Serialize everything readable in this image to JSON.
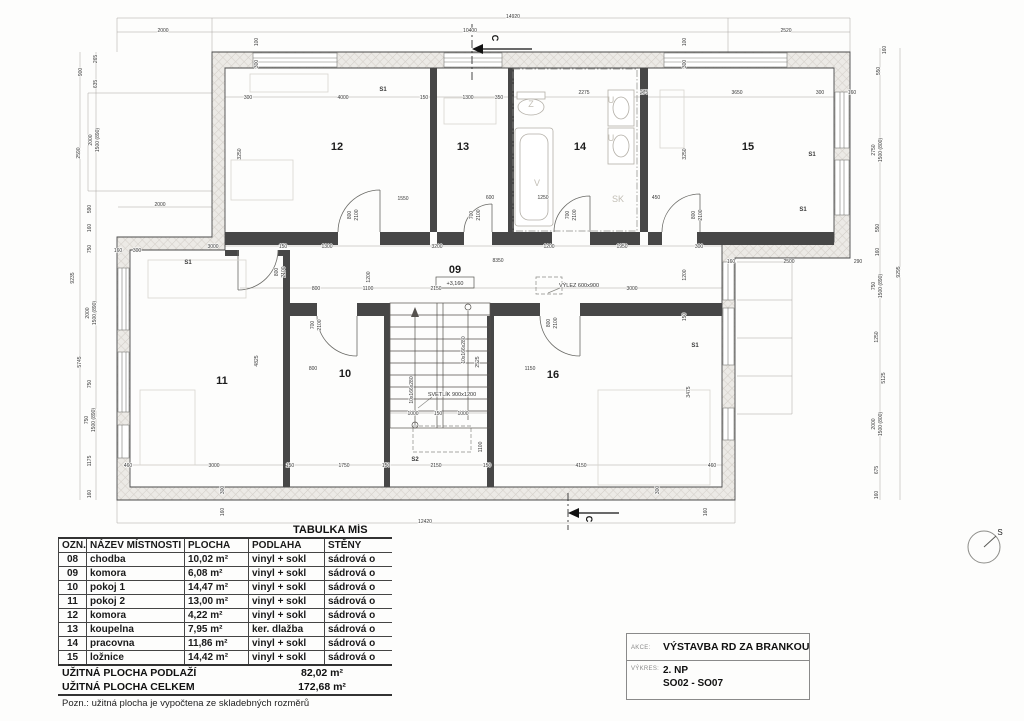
{
  "plan": {
    "compass_label": "S",
    "room_labels": [
      {
        "t": "12",
        "x": 337,
        "y": 150
      },
      {
        "t": "13",
        "x": 463,
        "y": 150
      },
      {
        "t": "14",
        "x": 580,
        "y": 150
      },
      {
        "t": "15",
        "x": 748,
        "y": 150
      },
      {
        "t": "11",
        "x": 222,
        "y": 384
      },
      {
        "t": "10",
        "x": 345,
        "y": 377
      },
      {
        "t": "16",
        "x": 553,
        "y": 378
      },
      {
        "t": "09",
        "x": 455,
        "y": 273
      }
    ],
    "zone_labels": [
      {
        "t": "S1",
        "x": 383,
        "y": 91
      },
      {
        "t": "S1",
        "x": 188,
        "y": 264
      },
      {
        "t": "S1",
        "x": 812,
        "y": 156
      },
      {
        "t": "S1",
        "x": 803,
        "y": 211
      },
      {
        "t": "S1",
        "x": 695,
        "y": 347
      },
      {
        "t": "S2",
        "x": 415,
        "y": 461
      }
    ],
    "fixture_labels": [
      {
        "t": "Z",
        "x": 531,
        "y": 107
      },
      {
        "t": "U",
        "x": 611,
        "y": 103
      },
      {
        "t": "U",
        "x": 611,
        "y": 141
      },
      {
        "t": "V",
        "x": 537,
        "y": 186
      },
      {
        "t": "SK",
        "x": 618,
        "y": 202
      }
    ],
    "annotations": [
      {
        "t": "SVĚTLÍK 900x1200",
        "x": 452,
        "y": 396
      },
      {
        "t": "VÝLEZ 600x900",
        "x": 579,
        "y": 287
      },
      {
        "t": "+3,160",
        "x": 455,
        "y": 285
      }
    ],
    "section_labels": [
      {
        "t": "C",
        "x": 492,
        "y": 38,
        "r": 2
      },
      {
        "t": "C",
        "x": 586,
        "y": 519,
        "r": 2
      }
    ],
    "dims": [
      {
        "t": "14920",
        "x": 513,
        "y": 18
      },
      {
        "t": "2000",
        "x": 163,
        "y": 32
      },
      {
        "t": "10400",
        "x": 470,
        "y": 32
      },
      {
        "t": "2520",
        "x": 786,
        "y": 32
      },
      {
        "t": "12420",
        "x": 425,
        "y": 523
      },
      {
        "t": "100",
        "x": 258,
        "y": 42,
        "r": 1
      },
      {
        "t": "300",
        "x": 258,
        "y": 64,
        "r": 1
      },
      {
        "t": "100",
        "x": 686,
        "y": 42,
        "r": 1
      },
      {
        "t": "300",
        "x": 686,
        "y": 64,
        "r": 1
      },
      {
        "t": "300",
        "x": 248,
        "y": 99
      },
      {
        "t": "4000",
        "x": 343,
        "y": 99
      },
      {
        "t": "150",
        "x": 424,
        "y": 99
      },
      {
        "t": "1300",
        "x": 468,
        "y": 99
      },
      {
        "t": "350",
        "x": 499,
        "y": 99
      },
      {
        "t": "2275",
        "x": 584,
        "y": 94
      },
      {
        "t": "275",
        "x": 644,
        "y": 94
      },
      {
        "t": "3650",
        "x": 737,
        "y": 94
      },
      {
        "t": "300",
        "x": 820,
        "y": 94
      },
      {
        "t": "160",
        "x": 852,
        "y": 94
      },
      {
        "t": "265",
        "x": 97,
        "y": 59,
        "r": 1
      },
      {
        "t": "900",
        "x": 82,
        "y": 72,
        "r": 1
      },
      {
        "t": "635",
        "x": 97,
        "y": 84,
        "r": 1
      },
      {
        "t": "2590",
        "x": 80,
        "y": 153,
        "r": 1
      },
      {
        "t": "2000",
        "x": 92,
        "y": 140,
        "r": 1
      },
      {
        "t": "1500 (890)",
        "x": 99,
        "y": 140,
        "r": 1
      },
      {
        "t": "590",
        "x": 91,
        "y": 209,
        "r": 1
      },
      {
        "t": "160",
        "x": 91,
        "y": 228,
        "r": 1
      },
      {
        "t": "750",
        "x": 91,
        "y": 249,
        "r": 1
      },
      {
        "t": "9235",
        "x": 74,
        "y": 278,
        "r": 1
      },
      {
        "t": "2000",
        "x": 89,
        "y": 313,
        "r": 1
      },
      {
        "t": "1500 (890)",
        "x": 96,
        "y": 313,
        "r": 1
      },
      {
        "t": "5745",
        "x": 81,
        "y": 362,
        "r": 1
      },
      {
        "t": "750",
        "x": 91,
        "y": 384,
        "r": 1
      },
      {
        "t": "750",
        "x": 88,
        "y": 420,
        "r": 1
      },
      {
        "t": "1500 (890)",
        "x": 95,
        "y": 420,
        "r": 1
      },
      {
        "t": "1175",
        "x": 91,
        "y": 461,
        "r": 1
      },
      {
        "t": "160",
        "x": 91,
        "y": 494,
        "r": 1
      },
      {
        "t": "2000",
        "x": 160,
        "y": 206
      },
      {
        "t": "160",
        "x": 118,
        "y": 252
      },
      {
        "t": "300",
        "x": 137,
        "y": 252
      },
      {
        "t": "3000",
        "x": 213,
        "y": 248
      },
      {
        "t": "150",
        "x": 283,
        "y": 248
      },
      {
        "t": "1300",
        "x": 327,
        "y": 248
      },
      {
        "t": "3200",
        "x": 437,
        "y": 248
      },
      {
        "t": "1200",
        "x": 549,
        "y": 248
      },
      {
        "t": "1950",
        "x": 622,
        "y": 248
      },
      {
        "t": "300",
        "x": 699,
        "y": 248
      },
      {
        "t": "160",
        "x": 731,
        "y": 263
      },
      {
        "t": "2500",
        "x": 789,
        "y": 263
      },
      {
        "t": "290",
        "x": 858,
        "y": 263
      },
      {
        "t": "8350",
        "x": 498,
        "y": 262
      },
      {
        "t": "800",
        "x": 316,
        "y": 290
      },
      {
        "t": "1100",
        "x": 368,
        "y": 290
      },
      {
        "t": "2150",
        "x": 436,
        "y": 290
      },
      {
        "t": "3000",
        "x": 632,
        "y": 290
      },
      {
        "t": "1200",
        "x": 370,
        "y": 277,
        "r": 1
      },
      {
        "t": "1550",
        "x": 403,
        "y": 200
      },
      {
        "t": "600",
        "x": 490,
        "y": 199
      },
      {
        "t": "1250",
        "x": 543,
        "y": 199
      },
      {
        "t": "450",
        "x": 656,
        "y": 199
      },
      {
        "t": "1200",
        "x": 686,
        "y": 275,
        "r": 1
      },
      {
        "t": "150",
        "x": 686,
        "y": 317,
        "r": 1
      },
      {
        "t": "800",
        "x": 351,
        "y": 215,
        "r": 1
      },
      {
        "t": "2100",
        "x": 358,
        "y": 215,
        "r": 1
      },
      {
        "t": "700",
        "x": 473,
        "y": 215,
        "r": 1
      },
      {
        "t": "2100",
        "x": 480,
        "y": 215,
        "r": 1
      },
      {
        "t": "700",
        "x": 569,
        "y": 215,
        "r": 1
      },
      {
        "t": "2100",
        "x": 576,
        "y": 215,
        "r": 1
      },
      {
        "t": "800",
        "x": 695,
        "y": 215,
        "r": 1
      },
      {
        "t": "2100",
        "x": 702,
        "y": 215,
        "r": 1
      },
      {
        "t": "800",
        "x": 278,
        "y": 272,
        "r": 1
      },
      {
        "t": "2100",
        "x": 285,
        "y": 272,
        "r": 1
      },
      {
        "t": "700",
        "x": 314,
        "y": 325,
        "r": 1
      },
      {
        "t": "2100",
        "x": 321,
        "y": 325,
        "r": 1
      },
      {
        "t": "800",
        "x": 550,
        "y": 323,
        "r": 1
      },
      {
        "t": "2100",
        "x": 557,
        "y": 323,
        "r": 1
      },
      {
        "t": "3250",
        "x": 241,
        "y": 154,
        "r": 1
      },
      {
        "t": "3250",
        "x": 686,
        "y": 154,
        "r": 1
      },
      {
        "t": "4825",
        "x": 258,
        "y": 361,
        "r": 1
      },
      {
        "t": "2525",
        "x": 479,
        "y": 362,
        "r": 1
      },
      {
        "t": "10x166x280",
        "x": 465,
        "y": 350,
        "r": 1
      },
      {
        "t": "10x166x280",
        "x": 413,
        "y": 390,
        "r": 1
      },
      {
        "t": "800",
        "x": 313,
        "y": 370
      },
      {
        "t": "1150",
        "x": 530,
        "y": 370
      },
      {
        "t": "3475",
        "x": 690,
        "y": 392,
        "r": 1
      },
      {
        "t": "1000",
        "x": 413,
        "y": 415
      },
      {
        "t": "150",
        "x": 438,
        "y": 415
      },
      {
        "t": "1000",
        "x": 463,
        "y": 415
      },
      {
        "t": "1100",
        "x": 482,
        "y": 447,
        "r": 1
      },
      {
        "t": "460",
        "x": 128,
        "y": 467
      },
      {
        "t": "3000",
        "x": 214,
        "y": 467
      },
      {
        "t": "150",
        "x": 290,
        "y": 467
      },
      {
        "t": "1750",
        "x": 344,
        "y": 467
      },
      {
        "t": "150",
        "x": 386,
        "y": 467
      },
      {
        "t": "2150",
        "x": 436,
        "y": 467
      },
      {
        "t": "150",
        "x": 487,
        "y": 467
      },
      {
        "t": "4150",
        "x": 581,
        "y": 467
      },
      {
        "t": "460",
        "x": 712,
        "y": 467
      },
      {
        "t": "300",
        "x": 224,
        "y": 490,
        "r": 1
      },
      {
        "t": "160",
        "x": 224,
        "y": 512,
        "r": 1
      },
      {
        "t": "300",
        "x": 659,
        "y": 490,
        "r": 1
      },
      {
        "t": "160",
        "x": 707,
        "y": 512,
        "r": 1
      },
      {
        "t": "160",
        "x": 886,
        "y": 50,
        "r": 1
      },
      {
        "t": "550",
        "x": 880,
        "y": 71,
        "r": 1
      },
      {
        "t": "2750",
        "x": 875,
        "y": 150,
        "r": 1
      },
      {
        "t": "1500 (800)",
        "x": 882,
        "y": 150,
        "r": 1
      },
      {
        "t": "550",
        "x": 879,
        "y": 228,
        "r": 1
      },
      {
        "t": "160",
        "x": 879,
        "y": 252,
        "r": 1
      },
      {
        "t": "750",
        "x": 875,
        "y": 286,
        "r": 1
      },
      {
        "t": "1500 (890)",
        "x": 882,
        "y": 286,
        "r": 1
      },
      {
        "t": "1250",
        "x": 878,
        "y": 337,
        "r": 1
      },
      {
        "t": "5125",
        "x": 885,
        "y": 378,
        "r": 1
      },
      {
        "t": "2000",
        "x": 875,
        "y": 424,
        "r": 1
      },
      {
        "t": "1500 (800)",
        "x": 882,
        "y": 424,
        "r": 1
      },
      {
        "t": "675",
        "x": 878,
        "y": 470,
        "r": 1
      },
      {
        "t": "160",
        "x": 878,
        "y": 495,
        "r": 1
      },
      {
        "t": "9295",
        "x": 900,
        "y": 272,
        "r": 1
      }
    ]
  },
  "table": {
    "title": "TABULKA MÍS",
    "headers": [
      "OZN.",
      "NÁZEV MÍSTNOSTI",
      "PLOCHA",
      "PODLAHA",
      "STĚNY"
    ],
    "rows": [
      [
        "08",
        "chodba",
        "10,02 m²",
        "vinyl + sokl",
        "sádrová o"
      ],
      [
        "09",
        "komora",
        "6,08 m²",
        "vinyl + sokl",
        "sádrová o"
      ],
      [
        "10",
        "pokoj 1",
        "14,47 m²",
        "vinyl + sokl",
        "sádrová o"
      ],
      [
        "11",
        "pokoj 2",
        "13,00 m²",
        "vinyl + sokl",
        "sádrová o"
      ],
      [
        "12",
        "komora",
        "4,22 m²",
        "vinyl + sokl",
        "sádrová o"
      ],
      [
        "13",
        "koupelna",
        "7,95 m²",
        "ker. dlažba",
        "sádrová o"
      ],
      [
        "14",
        "pracovna",
        "11,86 m²",
        "vinyl + sokl",
        "sádrová o"
      ],
      [
        "15",
        "ložnice",
        "14,42 m²",
        "vinyl + sokl",
        "sádrová o"
      ]
    ],
    "summary": [
      {
        "label": "UŽITNÁ PLOCHA PODLAŽÍ",
        "value": "82,02 m²"
      },
      {
        "label": "UŽITNÁ PLOCHA CELKEM",
        "value": "172,68 m²"
      }
    ],
    "note": "Pozn.: užitná plocha je vypočtena ze skladebných rozměrů"
  },
  "titleblock": {
    "akce_label": "AKCE:",
    "akce_value": "VÝSTAVBA RD ZA BRANKOU",
    "vykres_label": "VÝKRES:",
    "vykres_line1": "2. NP",
    "vykres_line2": "SO02 - SO07"
  }
}
